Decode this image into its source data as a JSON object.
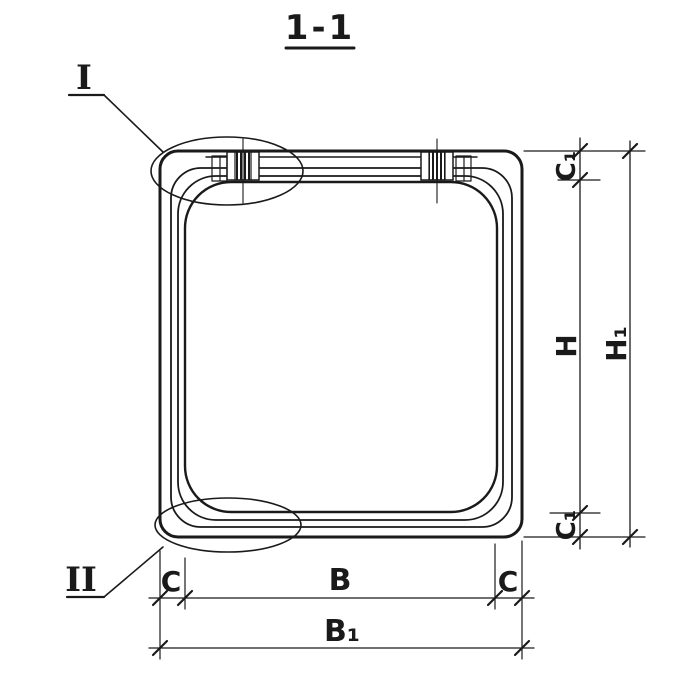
{
  "colors": {
    "ink": "#1a1a1a",
    "paper": "#ffffff"
  },
  "title": {
    "label": "1-1"
  },
  "callouts": {
    "detail_top": {
      "label": "I"
    },
    "detail_bottom": {
      "label": "II"
    }
  },
  "dims": {
    "c1_top": {
      "label": "C₁"
    },
    "h": {
      "label": "H"
    },
    "h1": {
      "label": "H₁"
    },
    "c1_bottom": {
      "label": "C₁"
    },
    "c_left": {
      "label": "C"
    },
    "b": {
      "label": "B"
    },
    "c_right": {
      "label": "C"
    },
    "b1": {
      "label": "B₁"
    }
  }
}
